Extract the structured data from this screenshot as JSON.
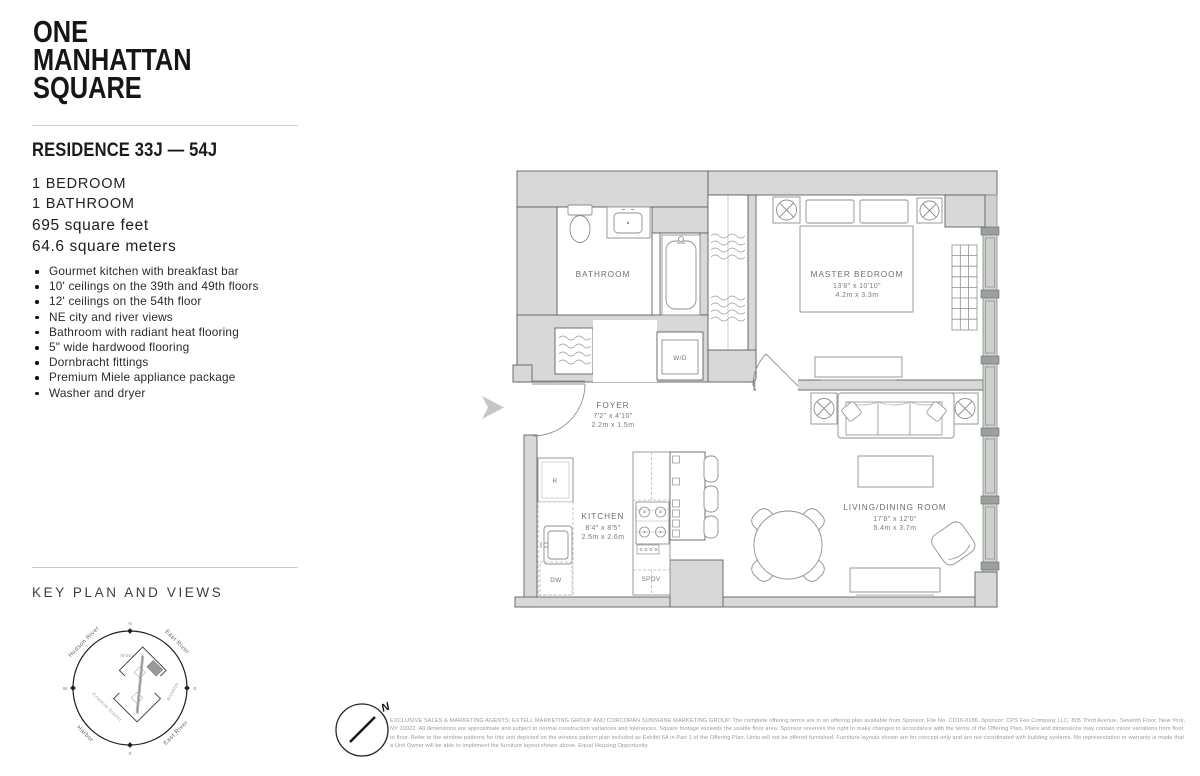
{
  "brand": {
    "line1": "ONE",
    "line2": "MANHATTAN",
    "line3": "SQUARE"
  },
  "residence": {
    "title": "RESIDENCE 33J — 54J",
    "bedrooms": "1 BEDROOM",
    "bathrooms": "1 BATHROOM",
    "area_ft": "695 square feet",
    "area_m": "64.6 square meters",
    "features": [
      "Gourmet kitchen with breakfast bar",
      "10' ceilings on the 39th and 49th floors",
      "12' ceilings on the 54th floor",
      "NE city and river views",
      "Bathroom with radiant heat flooring",
      "5\" wide hardwood flooring",
      "Dornbracht fittings",
      "Premium Miele appliance package",
      "Washer and dryer"
    ]
  },
  "key_plan": {
    "heading": "KEY PLAN AND VIEWS",
    "compass": {
      "n": "N",
      "e": "E",
      "s": "S",
      "w": "W"
    },
    "labels": {
      "hudson_river": "Hudson River",
      "east_river_top": "East River",
      "harbor": "Harbor",
      "east_river_bottom": "East River",
      "midtown": "Midtown",
      "brooklyn": "Brooklyn",
      "financial_district": "Financial District"
    }
  },
  "floor_plan": {
    "rooms": {
      "bathroom": {
        "name": "BATHROOM"
      },
      "master": {
        "name": "MASTER BEDROOM",
        "dim_ft": "13'8\" x 10'10\"",
        "dim_m": "4.2m x 3.3m"
      },
      "foyer": {
        "name": "FOYER",
        "dim_ft": "7'2\" x 4'10\"",
        "dim_m": "2.2m x 1.5m"
      },
      "kitchen": {
        "name": "KITCHEN",
        "dim_ft": "8'4\" x 8'5\"",
        "dim_m": "2.5m x 2.6m"
      },
      "living": {
        "name": "LIVING/DINING ROOM",
        "dim_ft": "17'8\" x 12'0\"",
        "dim_m": "5.4m x 3.7m"
      }
    },
    "appliances": {
      "wd": "W/D",
      "r": "R",
      "dw": "DW",
      "spov": "SPOV"
    }
  },
  "footer": {
    "north": "N",
    "disclaimer": "EXCLUSIVE SALES & MARKETING AGENTS: EXTELL MARKETING GROUP AND CORCORAN SUNSHINE MARKETING GROUP. The complete offering terms are in an offering plan available from Sponsor. File No. CD16-0186. Sponsor: CPS Fee Company LLC, 805 Third Avenue, Seventh Floor, New York, NY 10022. All dimensions are approximate and subject to normal construction variances and tolerances. Square footage exceeds the usable floor area. Sponsor reserves the right to make changes in accordance with the terms of the Offering Plan. Plans and dimensions may contain minor variations from floor to floor. Refer to the window patterns for this unit depicted on the window pattern plan included as Exhibit 6A in Part 1 of the Offering Plan. Units will not be offered furnished. Furniture layouts shown are for concept only and are not coordinated with building systems. No representation or warranty is made that a Unit Owner will be able to implement the furniture layout shown above. Equal Housing Opportunity."
  }
}
